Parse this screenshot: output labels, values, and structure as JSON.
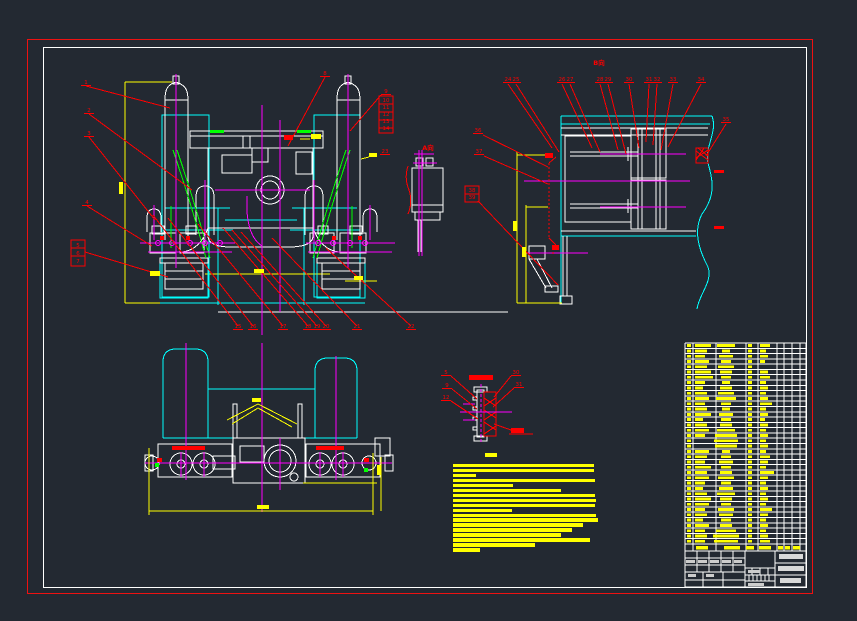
{
  "app": {
    "type": "cad-engineering-drawing",
    "background": "#232932",
    "palette": {
      "frame_red": "#ee1111",
      "white": "#ffffff",
      "cyan": "#00ffff",
      "magenta": "#ff00ff",
      "yellow": "#ffff00",
      "green": "#00ff00",
      "red": "#ff0000",
      "titleblock_text": "#d9d9d9"
    }
  },
  "frame": {
    "outer": {
      "x": 27,
      "y": 39,
      "w": 786,
      "h": 555
    },
    "inner": {
      "x": 43,
      "y": 47,
      "w": 764,
      "h": 541
    }
  },
  "annotations": {
    "view_labels": [
      {
        "x": 428,
        "y": 150,
        "t": "A向"
      },
      {
        "x": 599,
        "y": 65,
        "t": "B向"
      }
    ],
    "balloons": [
      {
        "x": 86,
        "y": 84,
        "t": "1"
      },
      {
        "x": 89,
        "y": 112,
        "t": "2"
      },
      {
        "x": 89,
        "y": 135,
        "t": "3"
      },
      {
        "x": 87,
        "y": 204,
        "t": "4"
      },
      {
        "x": 78,
        "y": 247,
        "t": "5",
        "u": false
      },
      {
        "x": 78,
        "y": 255,
        "t": "6",
        "u": false
      },
      {
        "x": 78,
        "y": 263,
        "t": "7",
        "u": false
      },
      {
        "x": 325,
        "y": 75,
        "t": "8"
      },
      {
        "x": 386,
        "y": 93,
        "t": "9"
      },
      {
        "x": 386,
        "y": 102,
        "t": "10",
        "u": false
      },
      {
        "x": 386,
        "y": 109,
        "t": "11",
        "u": false
      },
      {
        "x": 386,
        "y": 116,
        "t": "12",
        "u": false
      },
      {
        "x": 386,
        "y": 123,
        "t": "13",
        "u": false
      },
      {
        "x": 386,
        "y": 130,
        "t": "14",
        "u": false
      },
      {
        "x": 238,
        "y": 328,
        "t": "15"
      },
      {
        "x": 253,
        "y": 328,
        "t": "16"
      },
      {
        "x": 283,
        "y": 328,
        "t": "17"
      },
      {
        "x": 308,
        "y": 328,
        "t": "18"
      },
      {
        "x": 317,
        "y": 328,
        "t": "19"
      },
      {
        "x": 326,
        "y": 328,
        "t": "20"
      },
      {
        "x": 357,
        "y": 328,
        "t": "21"
      },
      {
        "x": 411,
        "y": 328,
        "t": "22"
      },
      {
        "x": 385,
        "y": 153,
        "t": "23"
      },
      {
        "x": 508,
        "y": 81,
        "t": "24"
      },
      {
        "x": 516,
        "y": 81,
        "t": "25"
      },
      {
        "x": 562,
        "y": 81,
        "t": "26"
      },
      {
        "x": 570,
        "y": 81,
        "t": "27"
      },
      {
        "x": 600,
        "y": 81,
        "t": "28"
      },
      {
        "x": 608,
        "y": 81,
        "t": "29"
      },
      {
        "x": 629,
        "y": 81,
        "t": "30"
      },
      {
        "x": 649,
        "y": 81,
        "t": "31"
      },
      {
        "x": 657,
        "y": 81,
        "t": "32"
      },
      {
        "x": 673,
        "y": 81,
        "t": "33"
      },
      {
        "x": 701,
        "y": 81,
        "t": "34"
      },
      {
        "x": 726,
        "y": 121,
        "t": "35"
      },
      {
        "x": 478,
        "y": 132,
        "t": "36"
      },
      {
        "x": 479,
        "y": 153,
        "t": "37"
      },
      {
        "x": 472,
        "y": 192,
        "t": "38",
        "u": false
      },
      {
        "x": 472,
        "y": 199,
        "t": "39",
        "u": false
      },
      {
        "x": 446,
        "y": 374,
        "t": "5"
      },
      {
        "x": 447,
        "y": 387,
        "t": "9"
      },
      {
        "x": 446,
        "y": 399,
        "t": "12"
      },
      {
        "x": 516,
        "y": 374,
        "t": "30"
      },
      {
        "x": 519,
        "y": 386,
        "t": "31"
      }
    ],
    "stack_boxes": [
      [
        71,
        240,
        14,
        26
      ],
      [
        379,
        96,
        14,
        37
      ],
      [
        465,
        186,
        14,
        16
      ]
    ],
    "leaders": [
      [
        86,
        86,
        170,
        108
      ],
      [
        89,
        114,
        192,
        190
      ],
      [
        89,
        137,
        155,
        220
      ],
      [
        87,
        206,
        152,
        246
      ],
      [
        85,
        252,
        168,
        277
      ],
      [
        325,
        77,
        288,
        146
      ],
      [
        381,
        95,
        350,
        131
      ],
      [
        153,
        215,
        238,
        326
      ],
      [
        168,
        218,
        253,
        326
      ],
      [
        198,
        224,
        283,
        326
      ],
      [
        223,
        228,
        308,
        326
      ],
      [
        232,
        230,
        317,
        326
      ],
      [
        241,
        232,
        326,
        326
      ],
      [
        272,
        238,
        357,
        326
      ],
      [
        326,
        248,
        411,
        326
      ],
      [
        508,
        84,
        552,
        148
      ],
      [
        516,
        84,
        559,
        152
      ],
      [
        562,
        84,
        592,
        148
      ],
      [
        570,
        84,
        600,
        152
      ],
      [
        600,
        84,
        618,
        150
      ],
      [
        608,
        84,
        626,
        154
      ],
      [
        629,
        84,
        639,
        148
      ],
      [
        649,
        84,
        646,
        142
      ],
      [
        657,
        84,
        653,
        145
      ],
      [
        673,
        84,
        661,
        150
      ],
      [
        701,
        84,
        668,
        147
      ],
      [
        726,
        124,
        706,
        156
      ],
      [
        483,
        135,
        548,
        167
      ],
      [
        484,
        156,
        548,
        184
      ],
      [
        478,
        201,
        558,
        285
      ],
      [
        451,
        376,
        477,
        399
      ],
      [
        452,
        389,
        477,
        409
      ],
      [
        451,
        401,
        478,
        419
      ],
      [
        511,
        376,
        494,
        397
      ],
      [
        514,
        388,
        493,
        407
      ],
      [
        494,
        424,
        511,
        430
      ]
    ],
    "yellow_text_marks": [
      [
        311,
        134,
        10,
        5
      ],
      [
        369,
        153,
        8,
        4
      ],
      [
        150,
        271,
        10,
        5
      ],
      [
        254,
        269,
        10,
        4
      ],
      [
        354,
        276,
        9,
        4
      ],
      [
        119,
        182,
        4,
        12
      ],
      [
        513,
        221,
        4,
        10
      ],
      [
        522,
        247,
        4,
        10
      ],
      [
        252,
        398,
        9,
        4
      ],
      [
        257,
        505,
        12,
        4
      ],
      [
        377,
        465,
        4,
        10
      ]
    ],
    "detail_title_bar": [
      469,
      375,
      24,
      5
    ],
    "detail_bottom_tag": {
      "bar": [
        511,
        428,
        13,
        5
      ],
      "underline": [
        509,
        434,
        533,
        434
      ]
    }
  },
  "tech_requirements": {
    "x": 453,
    "y0": 464,
    "pitch": 4.95,
    "bar_h": 3.4,
    "title": {
      "x": 485,
      "y": 453,
      "w": 12,
      "h": 4
    },
    "line_widths": [
      141,
      141,
      23,
      142,
      60,
      108,
      142,
      143,
      142,
      59,
      143,
      145,
      130,
      119,
      108,
      137,
      82,
      27
    ]
  },
  "bom": {
    "x": 685,
    "y": 343,
    "right": 806,
    "rows": 38,
    "row_pitch": 5.289,
    "header_top": 544,
    "header_bottom": 551,
    "col_x": [
      685,
      693,
      716,
      746,
      758,
      777,
      784,
      792,
      800,
      806
    ],
    "header_bars": [
      [
        696,
        12
      ],
      [
        724,
        16
      ],
      [
        746,
        8
      ],
      [
        759,
        12
      ],
      [
        778,
        5
      ],
      [
        785,
        5
      ],
      [
        793,
        7
      ]
    ],
    "row_bars": [
      [
        16,
        18,
        4,
        10
      ],
      [
        12,
        8,
        4,
        6
      ],
      [
        10,
        14,
        4,
        8
      ],
      [
        14,
        10,
        4,
        5
      ],
      [
        12,
        16,
        4,
        0
      ],
      [
        16,
        12,
        4,
        8
      ],
      [
        18,
        10,
        4,
        10
      ],
      [
        10,
        8,
        4,
        6
      ],
      [
        8,
        12,
        4,
        8
      ],
      [
        12,
        16,
        4,
        6
      ],
      [
        14,
        20,
        4,
        8
      ],
      [
        10,
        10,
        4,
        12
      ],
      [
        12,
        8,
        4,
        6
      ],
      [
        16,
        14,
        4,
        8
      ],
      [
        8,
        10,
        4,
        5
      ],
      [
        12,
        12,
        4,
        8
      ],
      [
        14,
        18,
        4,
        6
      ],
      [
        10,
        22,
        4,
        8
      ],
      [
        0,
        24,
        4,
        6
      ],
      [
        0,
        22,
        4,
        8
      ],
      [
        14,
        8,
        4,
        6
      ],
      [
        12,
        10,
        4,
        10
      ],
      [
        10,
        14,
        4,
        8
      ],
      [
        16,
        10,
        4,
        6
      ],
      [
        12,
        12,
        4,
        14
      ],
      [
        14,
        16,
        4,
        8
      ],
      [
        10,
        10,
        4,
        6
      ],
      [
        8,
        14,
        4,
        8
      ],
      [
        12,
        18,
        4,
        6
      ],
      [
        16,
        12,
        4,
        8
      ],
      [
        14,
        10,
        4,
        6
      ],
      [
        10,
        16,
        4,
        12
      ],
      [
        12,
        14,
        4,
        8
      ],
      [
        8,
        10,
        4,
        6
      ],
      [
        14,
        12,
        4,
        8
      ],
      [
        10,
        20,
        4,
        6
      ],
      [
        12,
        26,
        4,
        8
      ],
      [
        10,
        24,
        4,
        10
      ]
    ]
  },
  "title_block": {
    "x": 685,
    "y": 551,
    "right": 806,
    "bottom": 587,
    "text_bars": [
      {
        "x": 779,
        "y": 554,
        "w": 24,
        "h": 5,
        "color": "#d9d9d9"
      },
      {
        "x": 778,
        "y": 566,
        "w": 26,
        "h": 5,
        "color": "#d9d9d9"
      },
      {
        "x": 780,
        "y": 578,
        "w": 21,
        "h": 5,
        "color": "#d9d9d9"
      },
      {
        "x": 686,
        "y": 560,
        "w": 9,
        "h": 3,
        "color": "#cccccc"
      },
      {
        "x": 698,
        "y": 560,
        "w": 9,
        "h": 3,
        "color": "#cccccc"
      },
      {
        "x": 710,
        "y": 560,
        "w": 9,
        "h": 3,
        "color": "#cccccc"
      },
      {
        "x": 722,
        "y": 560,
        "w": 9,
        "h": 3,
        "color": "#cccccc"
      },
      {
        "x": 734,
        "y": 560,
        "w": 8,
        "h": 3,
        "color": "#cccccc"
      },
      {
        "x": 688,
        "y": 574,
        "w": 8,
        "h": 3,
        "color": "#cccccc"
      },
      {
        "x": 706,
        "y": 574,
        "w": 8,
        "h": 3,
        "color": "#cccccc"
      },
      {
        "x": 748,
        "y": 570,
        "w": 12,
        "h": 3,
        "color": "#cccccc"
      },
      {
        "x": 748,
        "y": 583,
        "w": 16,
        "h": 3,
        "color": "#cccccc"
      }
    ]
  }
}
